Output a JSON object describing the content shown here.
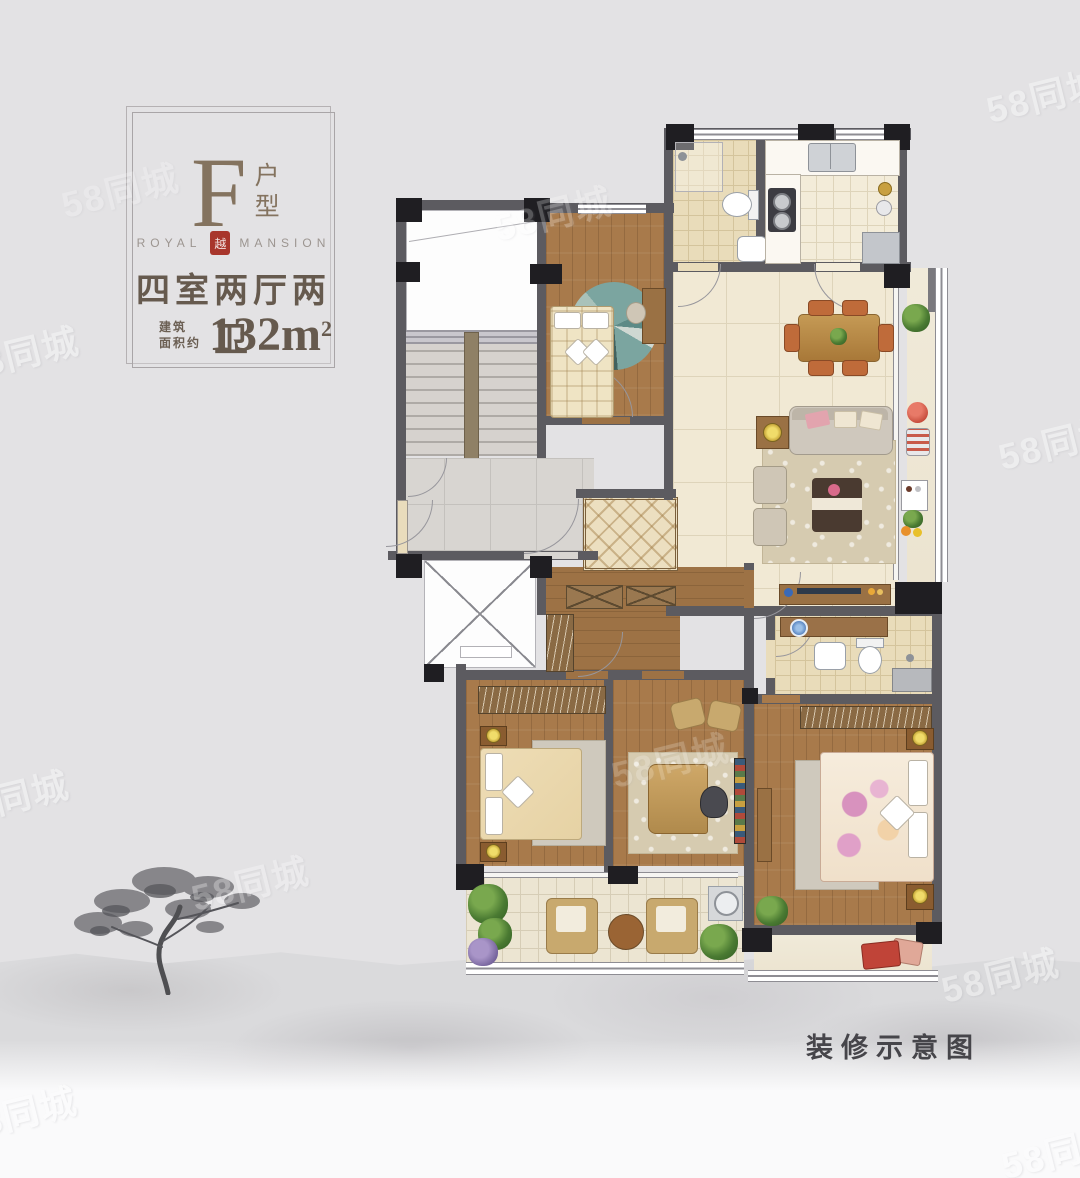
{
  "title_card": {
    "unit_letter": "F",
    "unit_label_top": "户",
    "unit_label_bottom": "型",
    "brand_left": "ROYAL",
    "brand_right": "MANSION",
    "seal_char": "越",
    "layout_text": "四室两厅两卫",
    "area_prefix_line1": "建筑",
    "area_prefix_line2": "面积约",
    "area_value": "132m",
    "area_sup": "2"
  },
  "footer": {
    "caption": "装修示意图"
  },
  "watermark": {
    "text": "58同城"
  },
  "colors": {
    "background": "#e3e2e4",
    "wall": "#5c5b60",
    "pier": "#1f1e22",
    "wood_floor": "#a87a4b",
    "tile_light": "#f1e9d4",
    "tile_beige": "#e9dcba",
    "common_marble": "#d8d5d1",
    "rug_teal": "#7ba5a0",
    "seal_red": "#a8362c",
    "title_text": "#665a4e",
    "caption_text": "#46454a",
    "watermark_color": "#ffffff"
  }
}
